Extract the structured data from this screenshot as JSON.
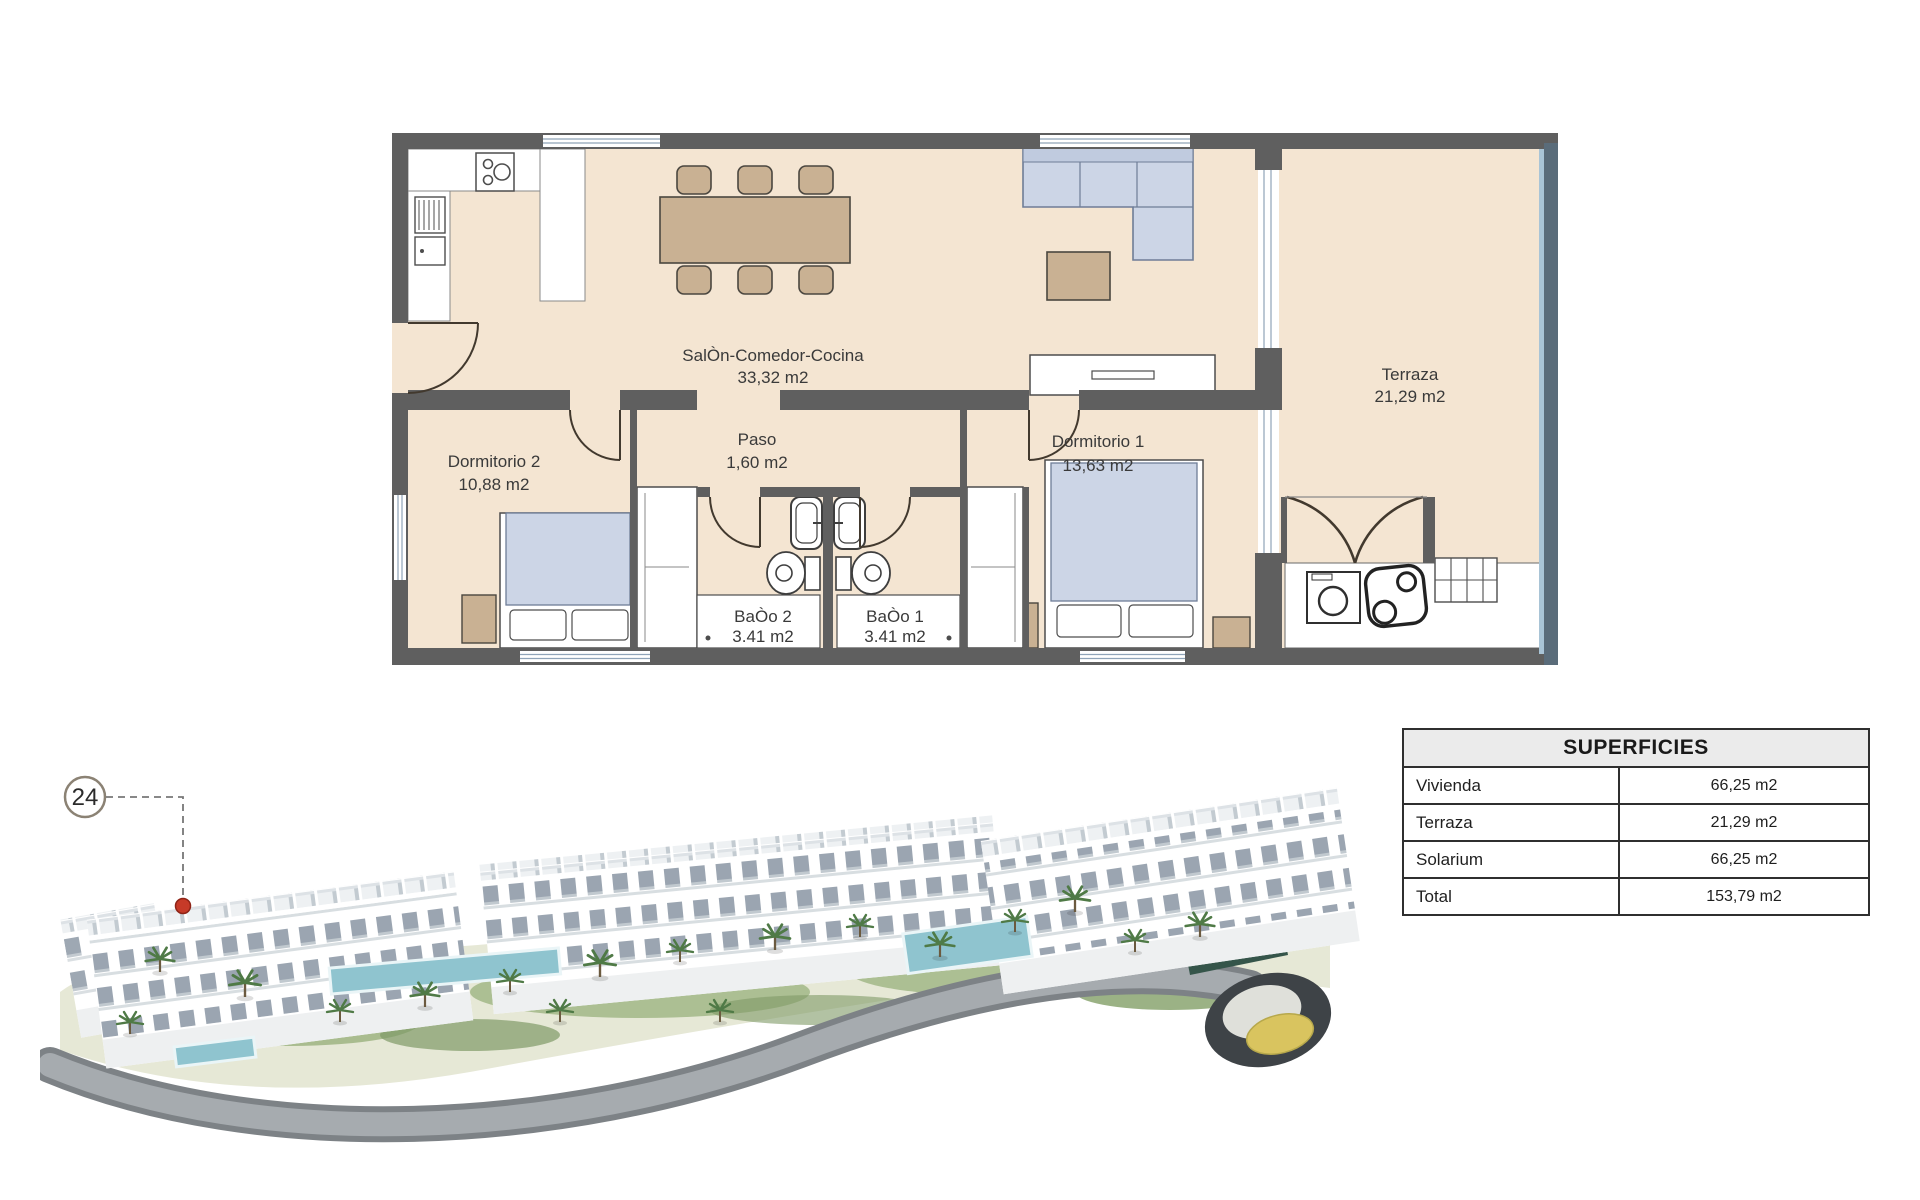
{
  "floor_plan": {
    "rooms": {
      "salon": {
        "name": "SalÒn-Comedor-Cocina",
        "area": "33,32 m2"
      },
      "dormitorio2": {
        "name": "Dormitorio 2",
        "area": "10,88 m2"
      },
      "paso": {
        "name": "Paso",
        "area": "1,60 m2"
      },
      "dormitorio1": {
        "name": "Dormitorio 1",
        "area": "13,63 m2"
      },
      "bano2": {
        "name": "BaÒo 2",
        "area": "3.41 m2"
      },
      "bano1": {
        "name": "BaÒo 1",
        "area": "3.41 m2"
      },
      "terraza": {
        "name": "Terraza",
        "area": "21,29 m2"
      }
    }
  },
  "site_plan": {
    "unit_badge": "24"
  },
  "superficies": {
    "title": "SUPERFICIES",
    "rows": [
      {
        "label": "Vivienda",
        "value": "66,25 m2"
      },
      {
        "label": "Terraza",
        "value": "21,29 m2"
      },
      {
        "label": "Solarium",
        "value": "66,25 m2"
      },
      {
        "label": "Total",
        "value": "153,79 m2"
      }
    ]
  },
  "colors": {
    "floor": "#f4e5d2",
    "wall": "#5f5f5f",
    "marker_red": "#c63a28",
    "roundabout_yellow": "#d9c45f"
  }
}
